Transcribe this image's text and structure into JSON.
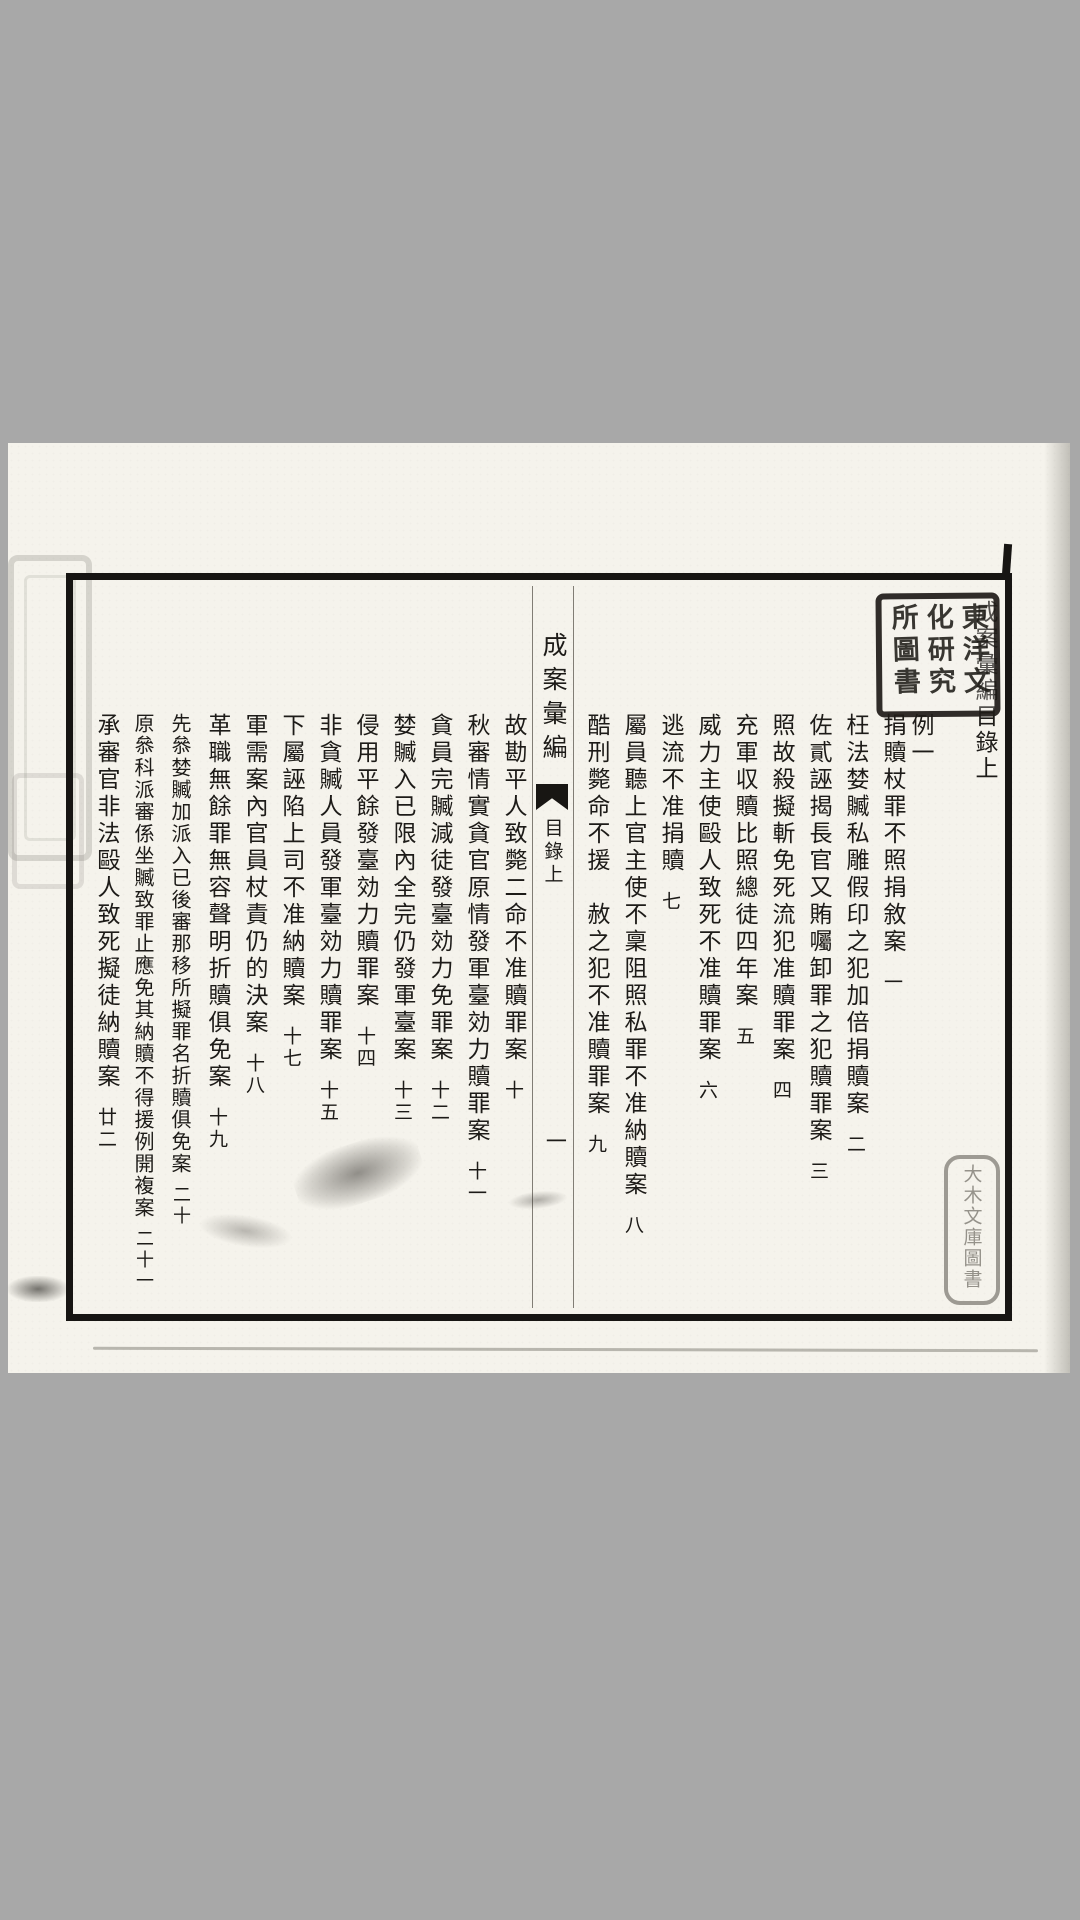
{
  "screen": {
    "background_color": "#a8a8a8",
    "paper_color": "#f5f3ec",
    "ink_color": "#1d1b18"
  },
  "header": {
    "title_column": "成案彙編目錄上",
    "section_label": "例一"
  },
  "fold": {
    "book_title": "成案彙編",
    "section_label": "目錄上",
    "leaf_number": "一"
  },
  "cases": [
    {
      "title": "捐贖杖罪不照捐敘案",
      "number": "一"
    },
    {
      "title": "枉法婪贓私雕假印之犯加倍捐贖案",
      "number": "二"
    },
    {
      "title": "佐貳誣揭長官又賄囑卸罪之犯贖罪案",
      "number": "三"
    },
    {
      "title": "照故殺擬斬免死流犯准贖罪案",
      "number": "四"
    },
    {
      "title": "充軍収贖比照總徒四年案",
      "number": "五"
    },
    {
      "title": "威力主使毆人致死不准贖罪案",
      "number": "六"
    },
    {
      "title": "逃流不准捐贖",
      "number": "七"
    },
    {
      "title": "屬員聽上官主使不稟阻照私罪不准納贖案",
      "number": "八"
    },
    {
      "title": "酷刑斃命不援　赦之犯不准贖罪案",
      "number": "九"
    },
    {
      "title": "故勘平人致斃二命不准贖罪案",
      "number": "十"
    },
    {
      "title": "秋審情實貪官原情發軍臺効力贖罪案",
      "number": "十一"
    },
    {
      "title": "貪員完贓減徒發臺効力免罪案",
      "number": "十二"
    },
    {
      "title": "婪贓入已限內全完仍發軍臺案",
      "number": "十三"
    },
    {
      "title": "侵用平餘發臺効力贖罪案",
      "number": "十四"
    },
    {
      "title": "非貪贓人員發軍臺効力贖罪案",
      "number": "十五"
    },
    {
      "title": "下屬誣陷上司不准納贖案",
      "number": "十七"
    },
    {
      "title": "軍需案內官員杖責仍的決案",
      "number": "十八"
    },
    {
      "title": "革職無餘罪無容聲明折贖俱免案",
      "number": "十九"
    },
    {
      "title": "先叅婪贓加派入已後審那移所擬罪名折贖俱免案",
      "number": "二十"
    },
    {
      "title": "原叅科派審係坐贓致罪止應免其納贖不得援例開複案",
      "number": "二十一"
    },
    {
      "title": "承審官非法毆人致死擬徒納贖案",
      "number": "廿二"
    }
  ],
  "seals": {
    "top_right": {
      "columns": [
        "東洋文",
        "化研究",
        "所圖書"
      ],
      "reading": "東洋文化研究所圖書"
    },
    "bottom_right": {
      "text": "大木文庫圖書"
    }
  }
}
